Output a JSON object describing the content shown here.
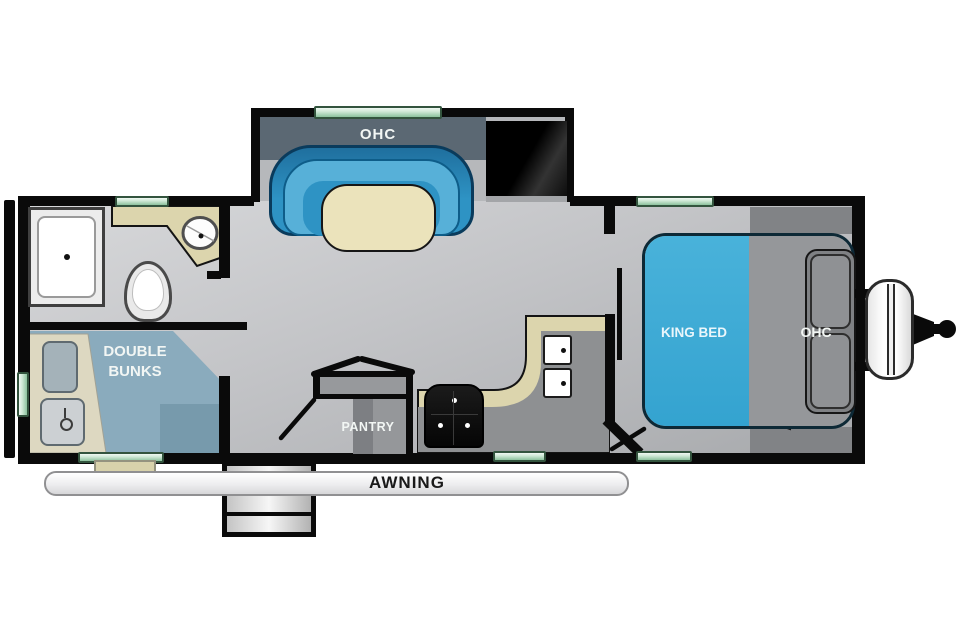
{
  "labels": {
    "slide_ohc": "OHC",
    "king_bed": "KING BED",
    "bed_ohc": "OHC",
    "double_bunks": "DOUBLE BUNKS",
    "pantry": "PANTRY",
    "awning": "AWNING"
  },
  "colors": {
    "wall": "#0a0a0a",
    "floor_light": "#d6d7d9",
    "floor_dark": "#a8aaad",
    "slide_band_gray": "#5b6873",
    "sofa_blue": "#2e93c4",
    "table_cream": "#ebe3bb",
    "bed_blue": "#36a6d2",
    "bunk_blue": "#8aabbd",
    "counter_tan": "#dcd5ad",
    "window_green": "#8cc29d",
    "tv_black": "#000000",
    "label_white": "#f2f6f4",
    "awning_text": "#1a1a1a"
  }
}
